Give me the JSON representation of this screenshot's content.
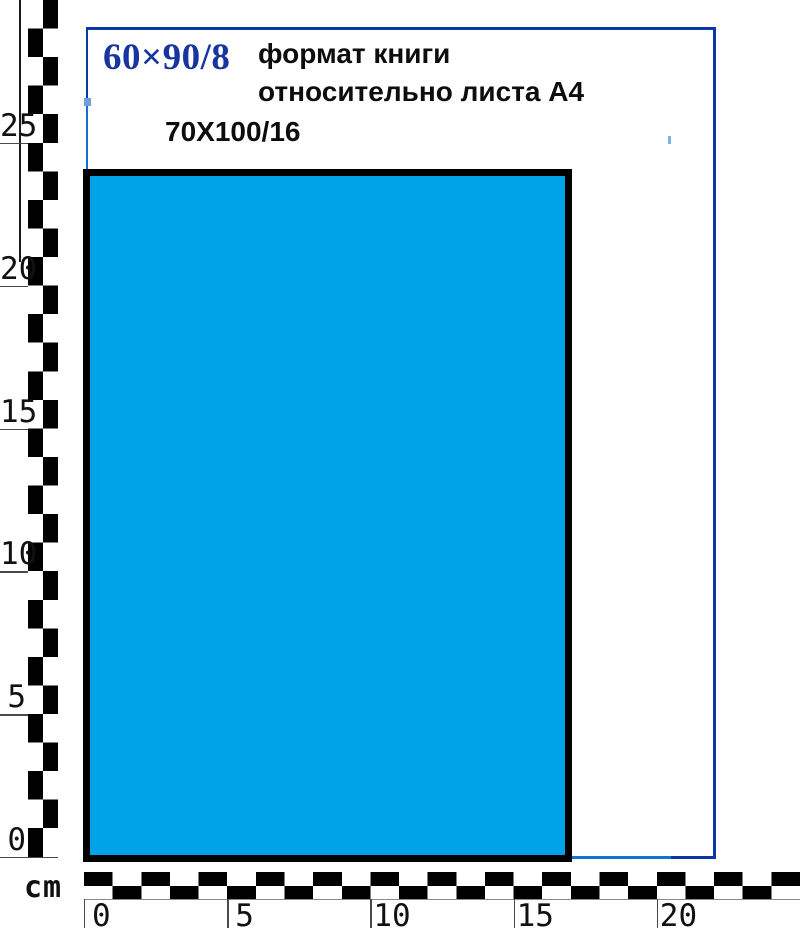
{
  "title": {
    "format_big": "60×90/8",
    "caption_line1": "формат книги",
    "caption_line2": "относительно листа А4",
    "format_small": "70X100/16"
  },
  "rulers": {
    "unit_label": "cm",
    "left_tick_values": [
      25,
      20,
      15,
      10,
      5,
      0
    ],
    "bottom_tick_values": [
      0,
      5,
      10,
      15,
      20
    ]
  },
  "colors": {
    "outer_border_navy": "#0b38a8",
    "outer_border_light": "#1273d6",
    "outer_handle_light": "#6fa0dc",
    "book_fill": "#00a2e8",
    "book_border": "#000000",
    "format_big_text": "#16359f",
    "caption_text": "#0d0d0d",
    "ruler_checker_dark": "#000000",
    "ruler_checker_light": "#ffffff"
  }
}
